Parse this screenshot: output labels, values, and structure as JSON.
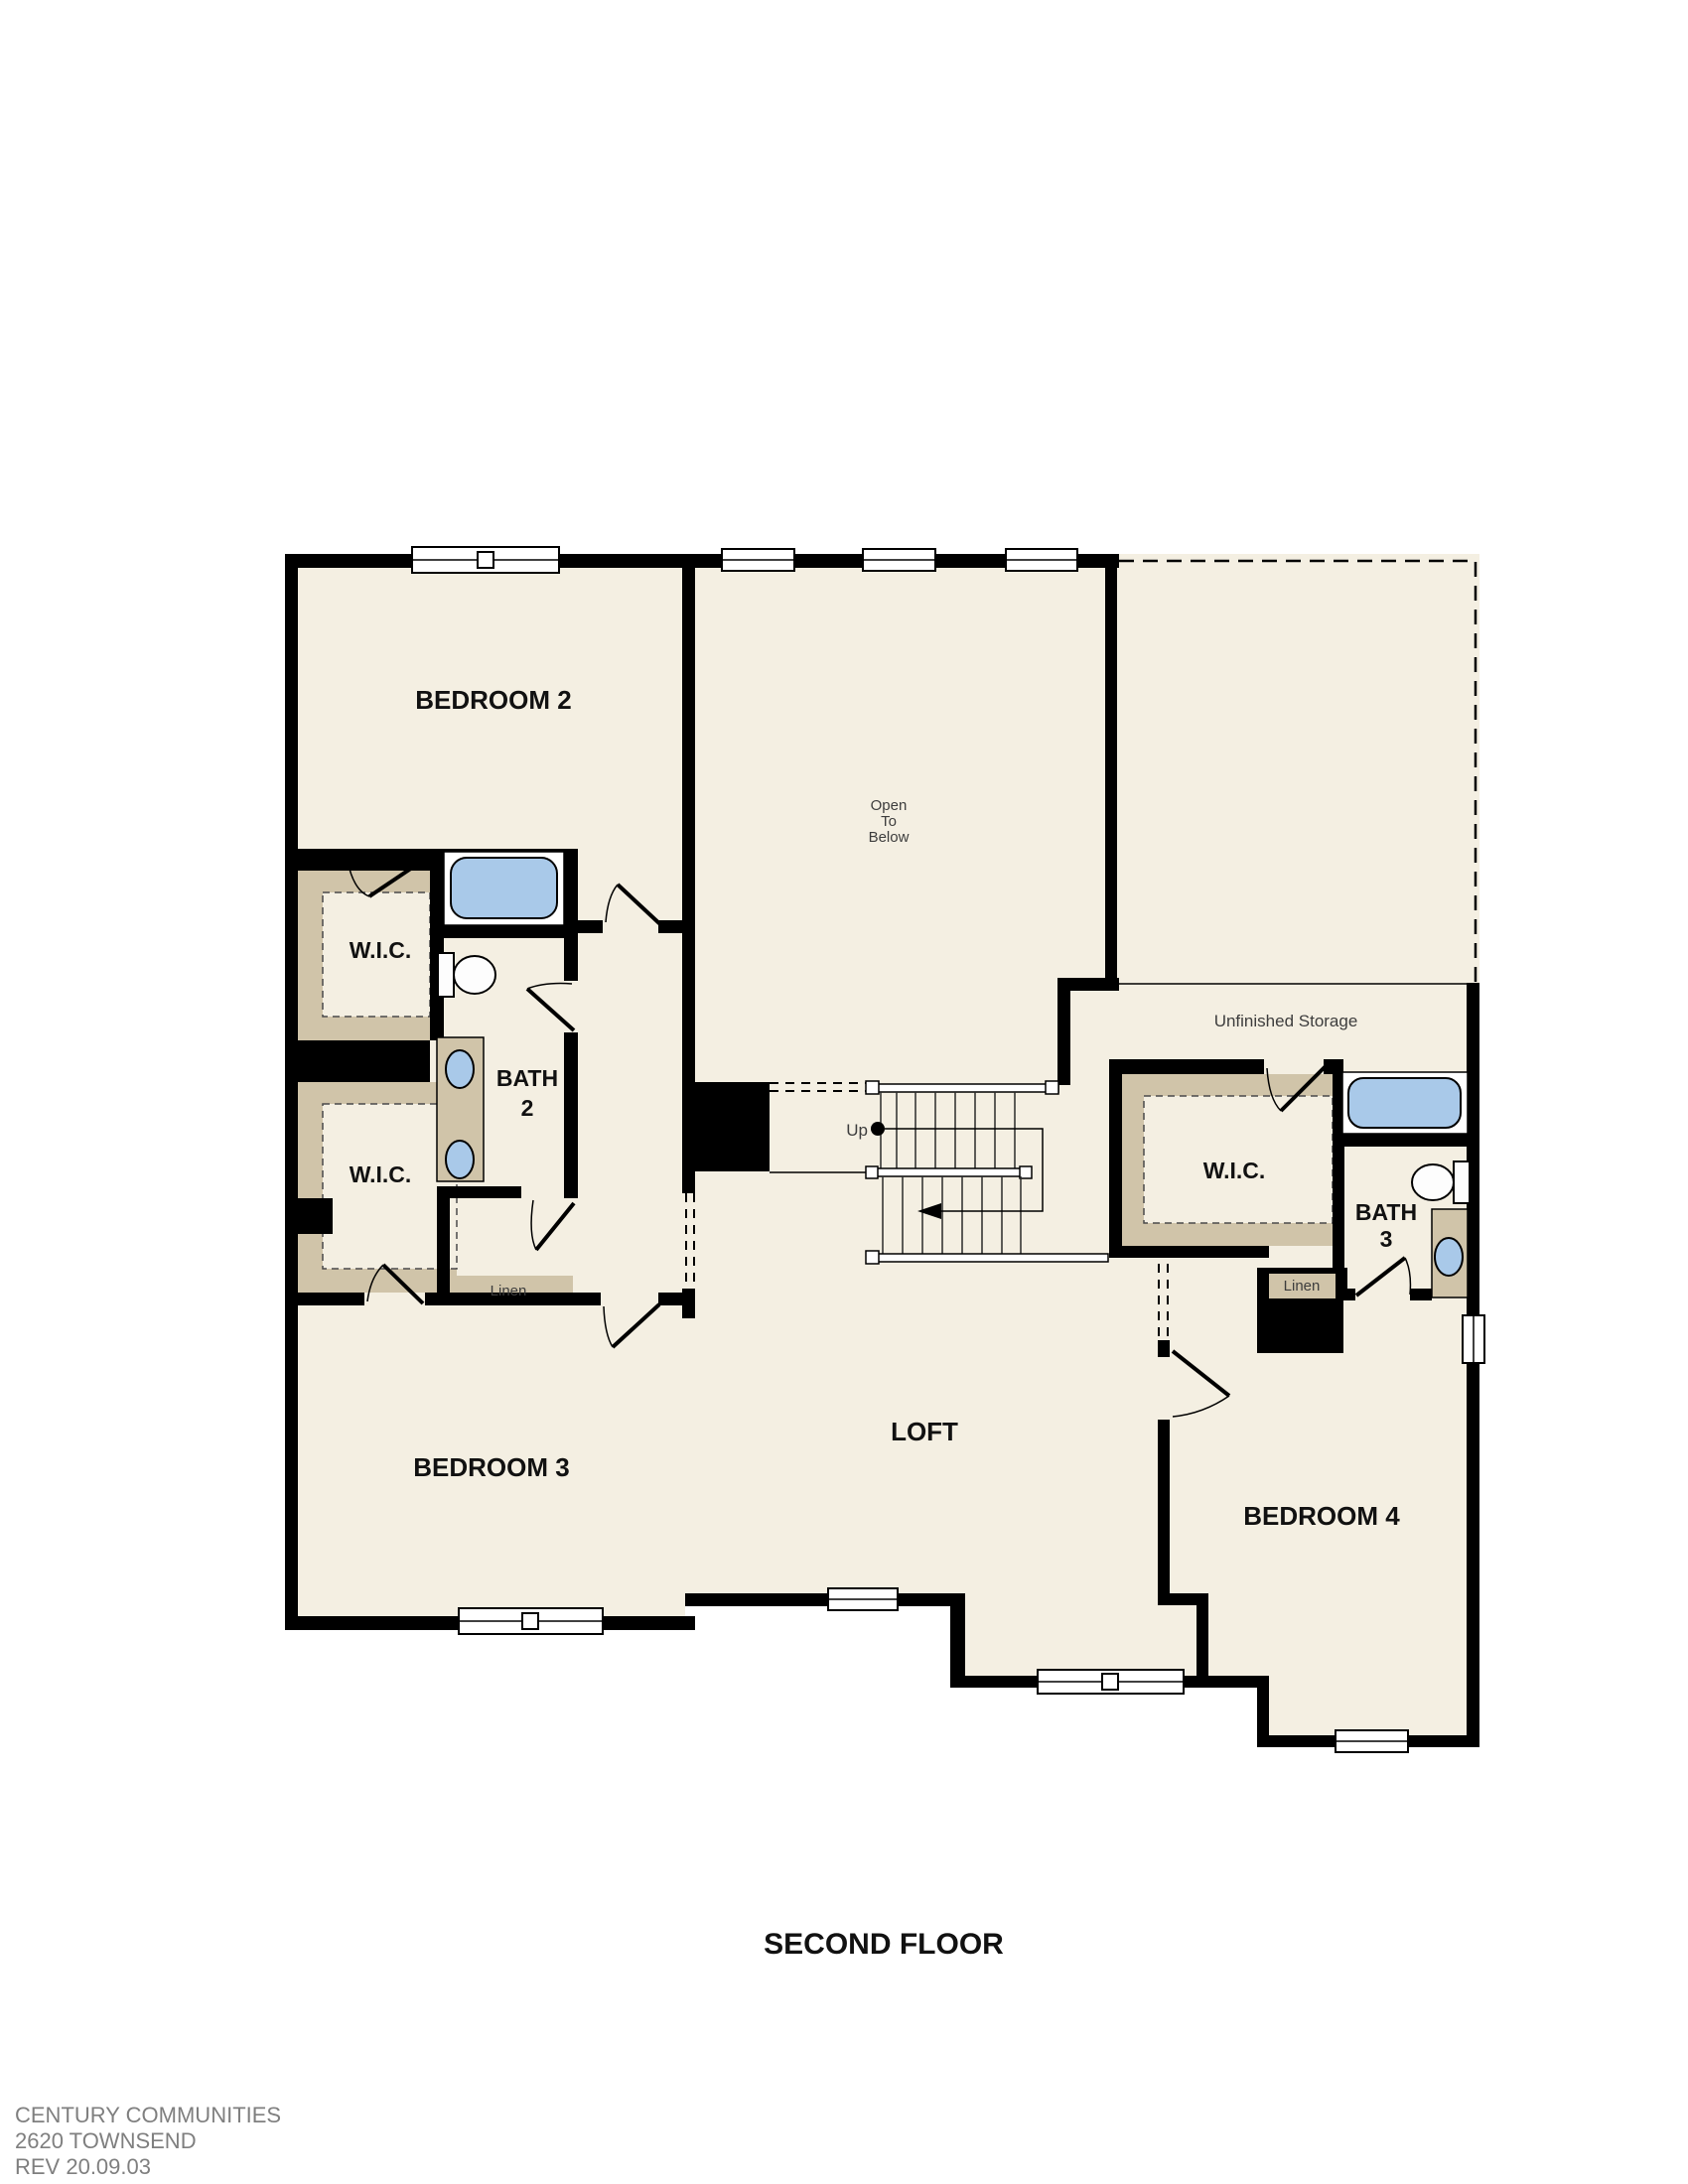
{
  "colors": {
    "wall": "#000000",
    "floor": "#f4efe2",
    "tan": "#d0c4a9",
    "fixture": "#a9c9e9",
    "labeldark": "#111111",
    "labelgray": "#3d3d3d",
    "footergray": "#7f7f7f"
  },
  "plan": {
    "rooms": {
      "bedroom2": {
        "label": "BEDROOM 2"
      },
      "bedroom3": {
        "label": "BEDROOM 3"
      },
      "bedroom4": {
        "label": "BEDROOM 4"
      },
      "loft": {
        "label": "LOFT"
      },
      "bath2": {
        "line1": "BATH",
        "line2": "2"
      },
      "bath3": {
        "line1": "BATH",
        "line2": "3"
      },
      "wic_upper": {
        "label": "W.I.C."
      },
      "wic_lower": {
        "label": "W.I.C."
      },
      "wic_right": {
        "label": "W.I.C."
      },
      "linen_left": {
        "label": "Linen"
      },
      "linen_right": {
        "label": "Linen"
      },
      "unfinished_storage": {
        "label": "Unfinished Storage"
      },
      "open_to_below": {
        "line1": "Open",
        "line2": "To",
        "line3": "Below"
      }
    },
    "stairs": {
      "up_label": "Up"
    }
  },
  "title": {
    "text": "SECOND FLOOR"
  },
  "footer": {
    "line1": "CENTURY COMMUNITIES",
    "line2": "2620 TOWNSEND",
    "line3": "REV 20.09.03"
  }
}
